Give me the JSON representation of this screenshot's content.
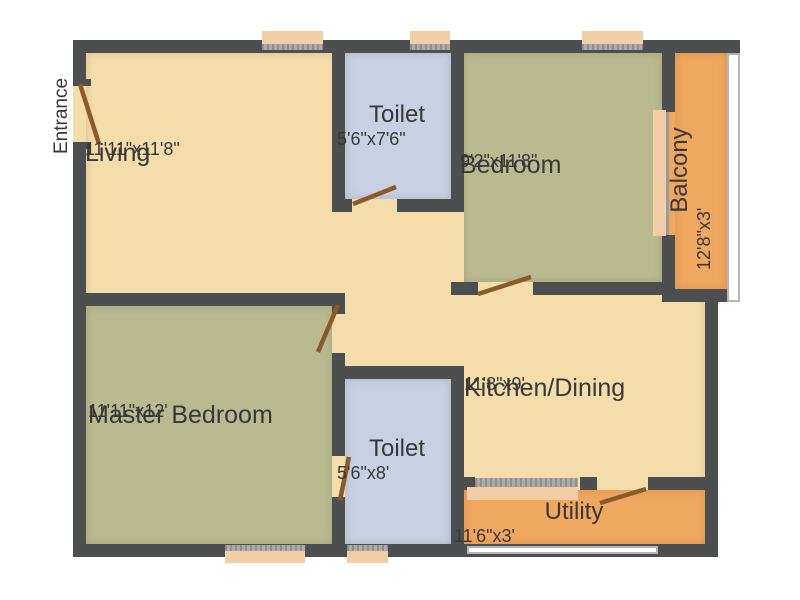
{
  "entrance": {
    "label": "Entrance"
  },
  "rooms": {
    "living": {
      "name": "Living",
      "dims": "11'11\"x11'8\""
    },
    "toilet_top": {
      "name": "Toilet",
      "dims": "5'6\"x7'6\""
    },
    "bedroom": {
      "name": "Bedroom",
      "dims": "9'2\"x11'8\""
    },
    "balcony": {
      "name": "Balcony",
      "dims": "12'8\"x3'"
    },
    "master_bedroom": {
      "name": "Master Bedroom",
      "dims": "11'11\"x12'"
    },
    "toilet_bottom": {
      "name": "Toilet",
      "dims": "5'6\"x8'"
    },
    "kitchen_dining": {
      "name": "Kitchen/Dining",
      "dims": "11'8\"x9'"
    },
    "utility": {
      "name": "Utility",
      "dims": "11'6\"x3'"
    }
  },
  "colors": {
    "wall": "#4d4e50",
    "floor": "#f5dcab",
    "bedroom-floor": "#b9ba90",
    "toilet-floor": "#c7d1e3",
    "balcony-floor": "#f0a75f",
    "window": "#f2cda6",
    "sill": "#9b9b9b",
    "door": "#8b5a2b",
    "railing": "#ffffff",
    "text": "#383838",
    "background": "#ffffff"
  }
}
